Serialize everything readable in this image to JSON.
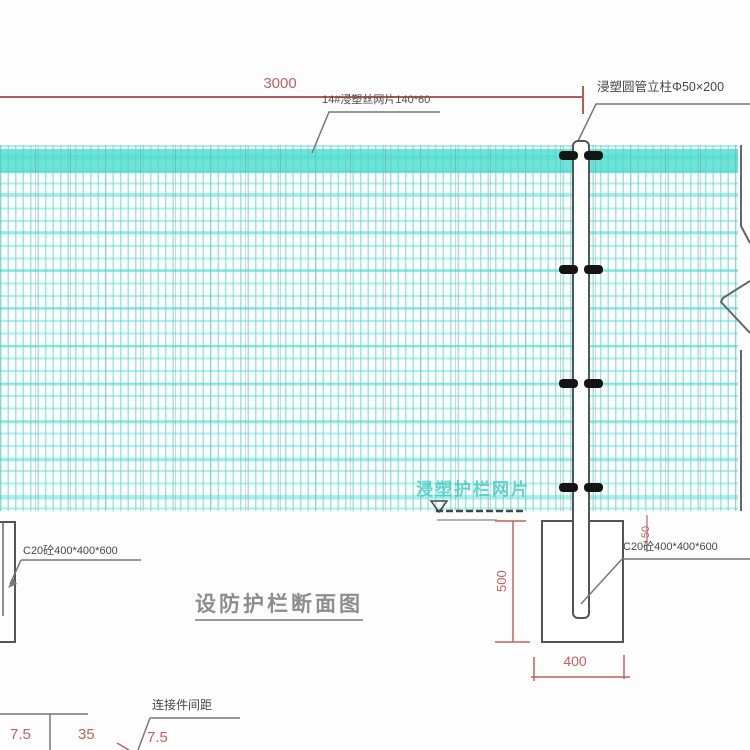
{
  "title": {
    "text": "设防护栏断面图"
  },
  "labels": {
    "mesh_panel": "14#浸塑丝网片140*60",
    "post": "浸塑圆管立柱Φ50×200",
    "foundation_left": "C20砼400*400*600",
    "foundation_right": "C20砼400*400*600",
    "connector_spacing": "连接件间距",
    "watermark": "浸塑护栏网片"
  },
  "dimensions": {
    "span": "3000",
    "embed_depth": "500",
    "exposed_offset": "50",
    "foundation_width": "400",
    "left_a": "7.5",
    "left_b": "35",
    "left_c": "7.5"
  },
  "colors": {
    "dimension_red": "#c0625f",
    "leader_gray": "#777777",
    "drawing_gray": "#555555",
    "mesh_cyan": "#4ad9cd",
    "clamp_black": "#141414",
    "title_gray": "#8d8d8d",
    "watermark_teal": "#27c5b9"
  }
}
